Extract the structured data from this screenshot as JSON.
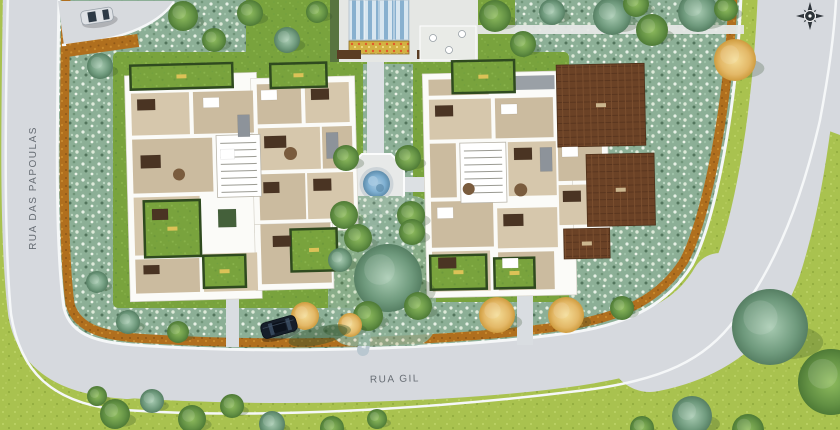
{
  "title": "Residential condominium site plan (top view)",
  "streets": {
    "left": {
      "name": "RUA DAS PAPOULAS",
      "orientation": "vertical"
    },
    "bottom": {
      "name": "RUA GIL",
      "orientation": "horizontal"
    }
  },
  "compass": {
    "icon": "compass-rose",
    "color": "#2e343a"
  },
  "site": {
    "buildings_count": 2,
    "cars_count": 2,
    "has_central_fountain": true,
    "has_entry_canopy": true
  },
  "colors": {
    "road": "#d6d9de",
    "sidewalk": "#f5f7f8",
    "lawn": "#79a33d",
    "outer_lawn": "#a9c24f",
    "shrub": "#8caf96",
    "mulch": "#b06f1e",
    "deck": "#6b4226",
    "building_wall": "#fbfbf8",
    "building_floor": "#d2c3a9",
    "fountain_water": "#7fb0d2",
    "canopy_blue": "#88b0cf",
    "flowerbed": "#d3b243"
  }
}
